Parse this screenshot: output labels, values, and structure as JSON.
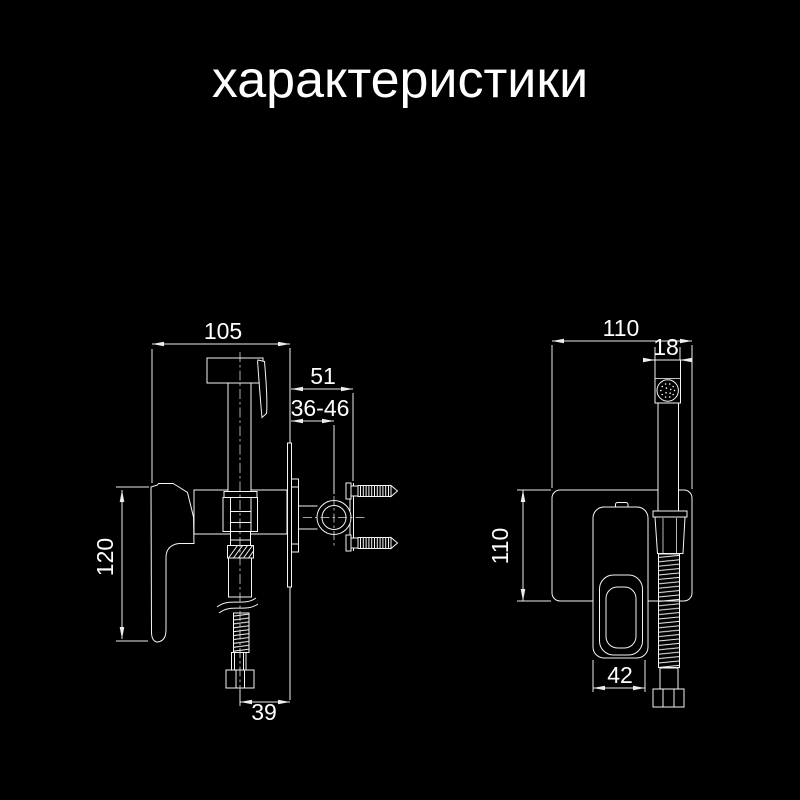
{
  "page": {
    "background_color": "#000000",
    "line_color": "#f5f5f5",
    "text_color": "#ffffff"
  },
  "title": {
    "text": "характеристики"
  },
  "drawing_type": "technical dimension drawing, hygienic shower bidet mixer",
  "views": {
    "left": {
      "name": "side view",
      "dimensions": {
        "width": "105",
        "wall_offset": "51",
        "mount_depth": "36-46",
        "height": "120",
        "hose_offset": "39"
      }
    },
    "right": {
      "name": "front view",
      "dimensions": {
        "width": "110",
        "head_width": "18",
        "height": "110",
        "trim_width": "42"
      }
    }
  }
}
